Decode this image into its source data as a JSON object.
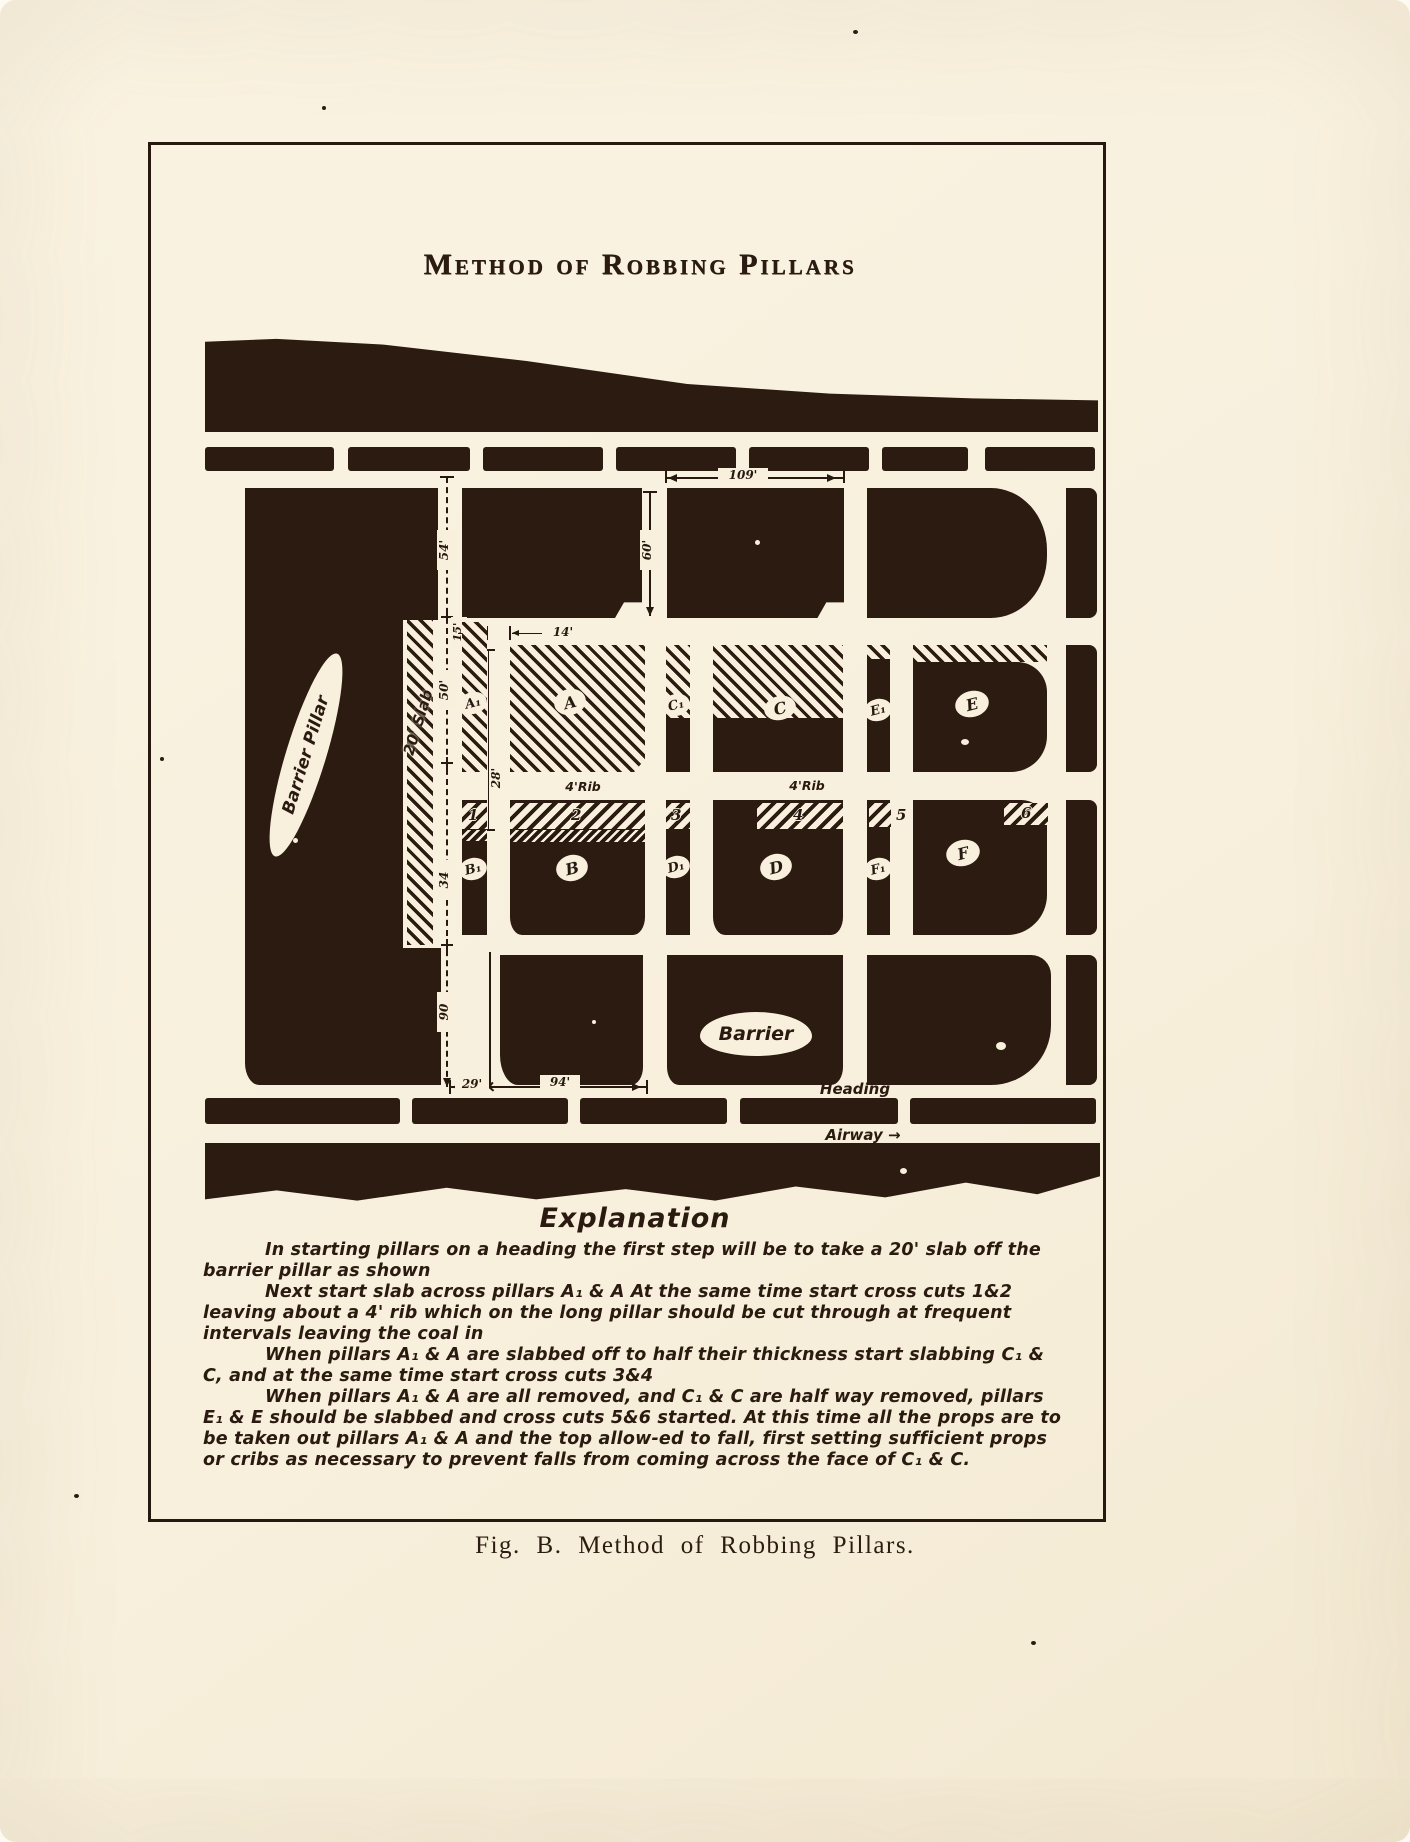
{
  "colors": {
    "paper": "#f8f0dd",
    "ink": "#2b1b11"
  },
  "page": {
    "title": "Method of Robbing Pillars",
    "caption": "Fig. B.  Method of Robbing Pillars."
  },
  "diagram": {
    "region_labels": {
      "barrier_pillar": "Barrier Pillar",
      "slab": "20' Slab",
      "barrier": "Barrier",
      "heading": "Heading",
      "airway": "Airway →",
      "rib_left": "4'Rib",
      "rib_right": "4'Rib"
    },
    "pillars": {
      "row2": [
        "A₁",
        "A",
        "C₁",
        "C",
        "E₁",
        "E"
      ],
      "row3": [
        "B₁",
        "B",
        "D₁",
        "D",
        "F₁",
        "F"
      ]
    },
    "cross_cuts": [
      "1",
      "2",
      "3",
      "4",
      "5",
      "6"
    ],
    "dimensions": {
      "top_pillar_width": "109'",
      "top_pillar_height": "60'",
      "chain_top": "54'",
      "chain_offset": "15'",
      "chain_row2": "50'",
      "cut_width": "14'",
      "rib_offset": "28'",
      "chain_row3": "34",
      "chain_bottom": "90",
      "bottom_left": "29'",
      "bottom_right": "94'"
    }
  },
  "explanation": {
    "title": "Explanation",
    "paragraphs": [
      "In starting pillars on a heading the first step will be to take a 20' slab off the barrier pillar as shown",
      "Next start slab across pillars A₁ & A At the same time start cross cuts 1&2 leaving about a 4' rib which on the long pillar should be cut through at frequent intervals leaving the coal in",
      "When pillars A₁ & A are slabbed off to half their thickness start slabbing C₁ & C, and at the same time start cross cuts 3&4",
      "When pillars A₁ & A are all removed, and C₁ & C are half way removed, pillars E₁ & E should be slabbed and cross cuts 5&6 started. At this time all the props are to be taken out pillars A₁ & A and the top allow-ed to fall, first setting sufficient props or cribs as necessary to prevent falls from coming across the face of C₁ & C."
    ]
  }
}
